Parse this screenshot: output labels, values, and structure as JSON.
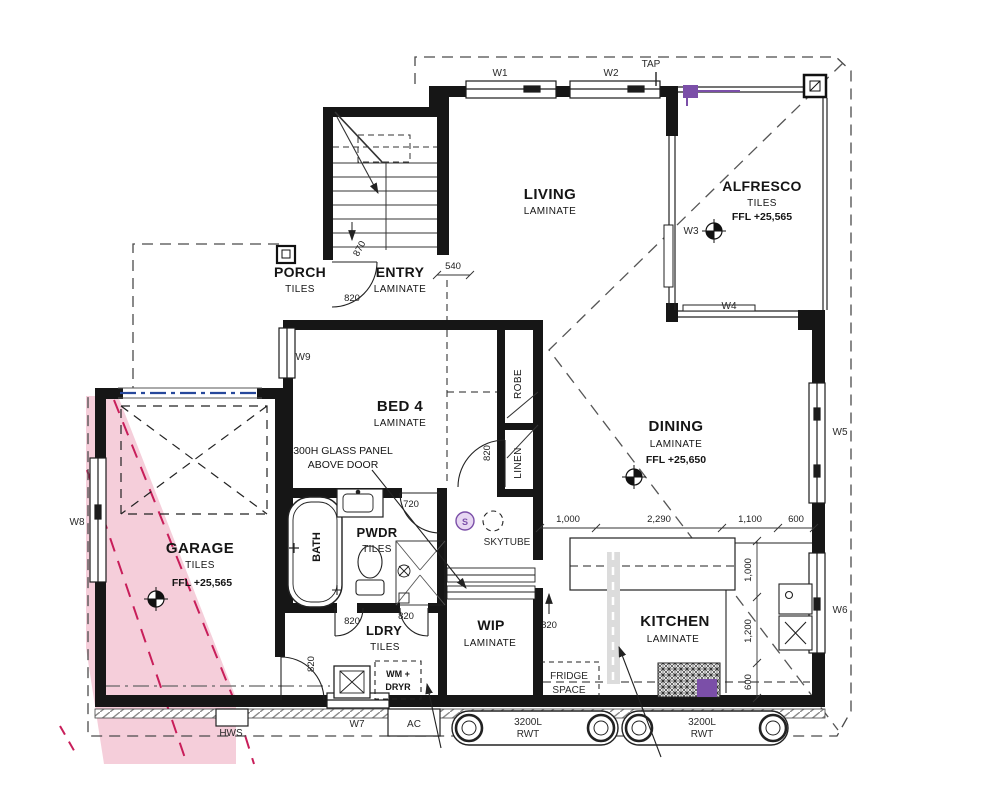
{
  "drawing": {
    "rooms": {
      "living": {
        "name": "LIVING",
        "finish": "LAMINATE"
      },
      "alfresco": {
        "name": "ALFRESCO",
        "finish": "TILES",
        "ffl": "FFL +25,565"
      },
      "porch": {
        "name": "PORCH",
        "finish": "TILES"
      },
      "entry": {
        "name": "ENTRY",
        "finish": "LAMINATE"
      },
      "bed4": {
        "name": "BED 4",
        "finish": "LAMINATE"
      },
      "dining": {
        "name": "DINING",
        "finish": "LAMINATE",
        "ffl": "FFL +25,650"
      },
      "garage": {
        "name": "GARAGE",
        "finish": "TILES",
        "ffl": "FFL +25,565"
      },
      "pwdr": {
        "name": "PWDR",
        "finish": "TILES"
      },
      "ldry": {
        "name": "LDRY",
        "finish": "TILES"
      },
      "wip": {
        "name": "WIP",
        "finish": "LAMINATE"
      },
      "kitchen": {
        "name": "KITCHEN",
        "finish": "LAMINATE"
      },
      "bath": {
        "name": "BATH"
      },
      "robe": {
        "name": "ROBE"
      },
      "linen": {
        "name": "LINEN"
      }
    },
    "windows": {
      "w1": "W1",
      "w2": "W2",
      "w3": "W3",
      "w4": "W4",
      "w5": "W5",
      "w6": "W6",
      "w7": "W7",
      "w8": "W8",
      "w9": "W9"
    },
    "fixtures": {
      "tap": "TAP",
      "hws": "HWS",
      "ac": "AC",
      "wm": "WM +",
      "dryr": "DRYR",
      "fridge_line1": "FRIDGE",
      "fridge_line2": "SPACE",
      "skytube": "SKYTUBE",
      "skytube_s": "S",
      "tank1_line1": "3200L",
      "tank1_line2": "RWT",
      "tank2_line1": "3200L",
      "tank2_line2": "RWT"
    },
    "annotations": {
      "glass_line1": "300H GLASS PANEL",
      "glass_line2": "ABOVE DOOR"
    },
    "dims": {
      "d540": "540",
      "d720": "720",
      "d820": "820",
      "d870": "870",
      "h": [
        "1,000",
        "2,290",
        "1,100",
        "600"
      ],
      "v": [
        "1,000",
        "1,200",
        "600"
      ]
    },
    "colors": {
      "wall": "#161616",
      "driveway_fill": "#f4c9d6",
      "driveway_line": "#c81e5a",
      "accent_purple": "#7b4fa8",
      "accent_blue": "#27489b"
    }
  }
}
